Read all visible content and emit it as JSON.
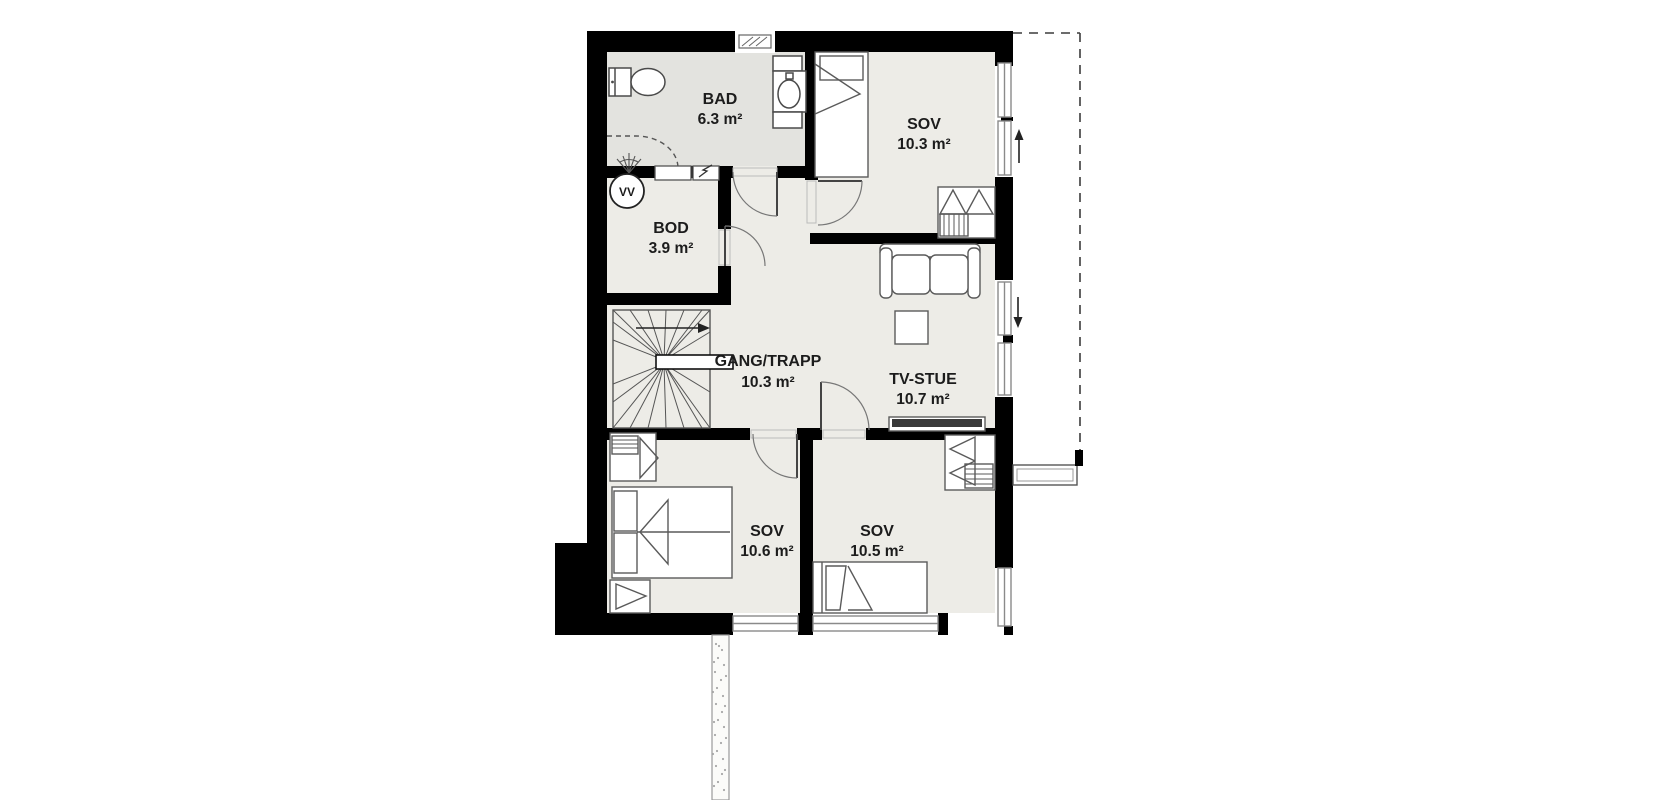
{
  "plan": {
    "type": "floor-plan",
    "floor_label": "",
    "rooms": [
      {
        "name": "BAD",
        "area": "6.3 m²",
        "kind": "bathroom"
      },
      {
        "name": "SOV",
        "area": "10.3 m²",
        "kind": "bedroom"
      },
      {
        "name": "BOD",
        "area": "3.9 m²",
        "kind": "storage"
      },
      {
        "name": "GANG/TRAPP",
        "area": "10.3 m²",
        "kind": "hallway-stairs"
      },
      {
        "name": "TV-STUE",
        "area": "10.7 m²",
        "kind": "tv-room"
      },
      {
        "name": "SOV",
        "area": "10.6 m²",
        "kind": "bedroom"
      },
      {
        "name": "SOV",
        "area": "10.5 m²",
        "kind": "bedroom"
      }
    ],
    "annotations": {
      "water_heater": "VV",
      "escape_arrow_up": "up",
      "escape_arrow_down": "down"
    },
    "fixtures": [
      "toilet",
      "wash-basin-unit",
      "shower-corner",
      "ventilation-hatch",
      "electrical-panel",
      "water-heater",
      "winder-staircase",
      "stair-direction-arrow",
      "single-bed-top",
      "wardrobe-bedroom-top",
      "sofa",
      "side-table",
      "tv-bench",
      "wardrobe-bedroom-left",
      "double-bed",
      "bedside-cabinet",
      "single-bed-bottom",
      "wardrobe-bedroom-right",
      "roof-overhang-dashed-outline",
      "entrance-beam",
      "support-post",
      "lower-wall-stipple-strip"
    ],
    "colors": {
      "wall": "#000000",
      "floor": "#edece7",
      "bathroom_floor": "#e3e3df",
      "furniture_stroke": "#5a5a5a",
      "window_frame": "#8a8a8a",
      "dashed_outline": "#3c3c3c",
      "background": "#ffffff"
    }
  }
}
